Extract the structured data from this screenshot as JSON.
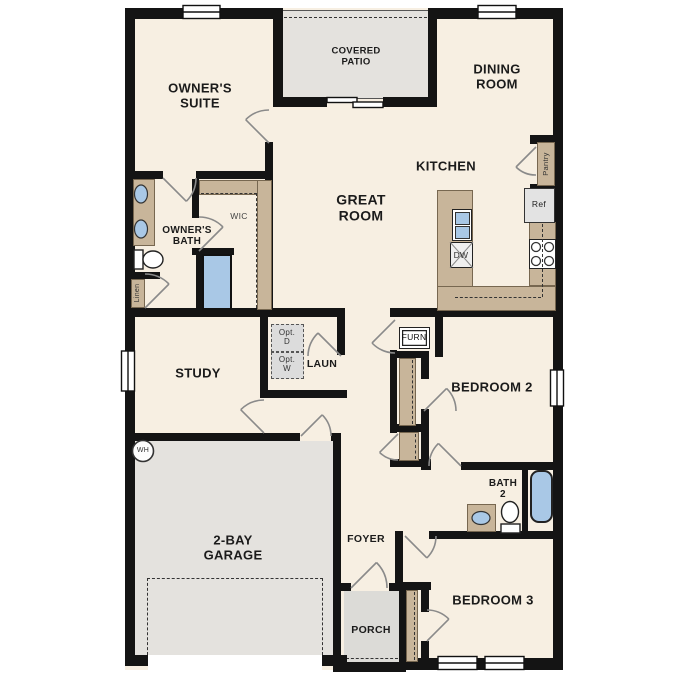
{
  "plan": {
    "rooms": {
      "owners_suite": "OWNER'S\nSUITE",
      "covered_patio": "COVERED\nPATIO",
      "dining_room": "DINING\nROOM",
      "kitchen": "KITCHEN",
      "great_room": "GREAT\nROOM",
      "owners_bath": "OWNER'S\nBATH",
      "wic": "WIC",
      "study": "STUDY",
      "laundry": "LAUN",
      "bedroom2": "BEDROOM 2",
      "bath2": "BATH\n2",
      "bedroom3": "BEDROOM 3",
      "garage": "2-BAY\nGARAGE",
      "foyer": "FOYER",
      "porch": "PORCH"
    },
    "fixtures": {
      "pantry": "Pantry",
      "ref": "Ref",
      "dw": "DW",
      "linen": "Linen",
      "opt_dryer": "Opt.\nD",
      "opt_washer": "Opt.\nW",
      "furnace": "FURN",
      "water_heater": "WH"
    },
    "colors": {
      "floor": "#f7efe2",
      "walls": "#141414",
      "cabinetry_tan": "#c8b59a",
      "plumbing_blue": "#a9c8e6",
      "outdoor_gray": "#e4e2de",
      "appliance_gray": "#e3e3e3"
    }
  }
}
